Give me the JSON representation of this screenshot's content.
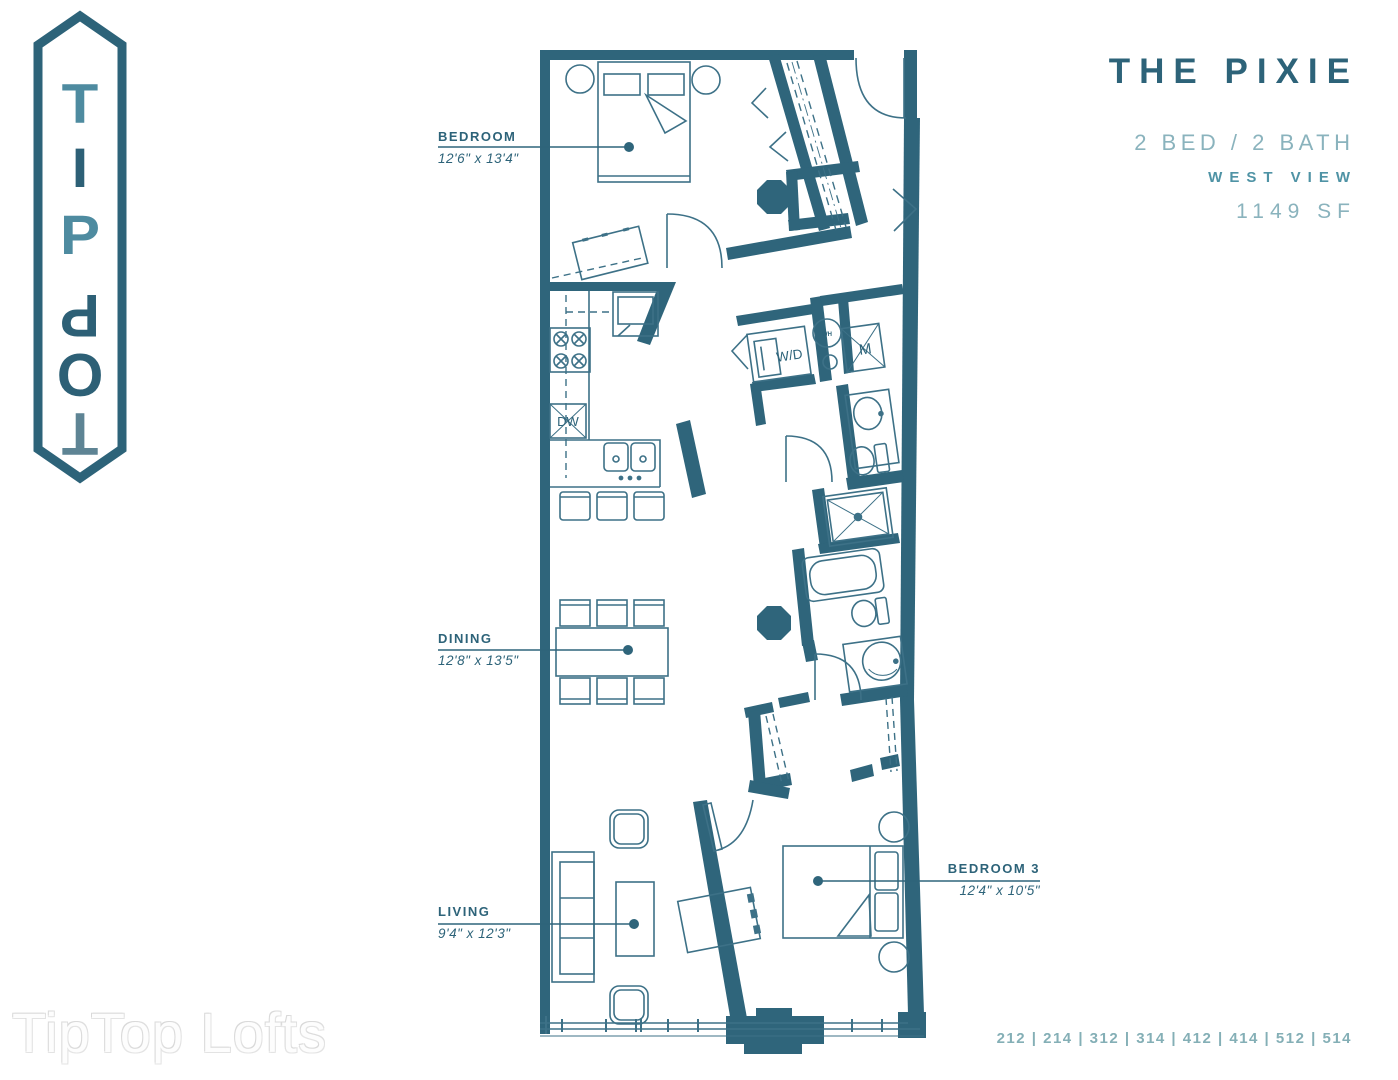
{
  "logo": {
    "brand": "TipTop",
    "letters": [
      "T",
      "I",
      "P",
      "P",
      "O",
      "T"
    ]
  },
  "title_block": {
    "name": "THE PIXIE",
    "beds_baths": "2 BED / 2 BATH",
    "view": "WEST VIEW",
    "area": "1149 SF"
  },
  "room_labels": [
    {
      "name": "BEDROOM",
      "dims": "12'6\" x 13'4\""
    },
    {
      "name": "DINING",
      "dims": "12'8\" x 13'5\""
    },
    {
      "name": "LIVING",
      "dims": "9'4\" x 12'3\""
    },
    {
      "name": "BEDROOM 3",
      "dims": "12'4\" x 10'5\""
    }
  ],
  "fixture_labels": {
    "washer_dryer": "W/D",
    "mechanical": "M",
    "water_heater": "WH",
    "dishwasher": "DW"
  },
  "units_list": "212 | 214 | 312 | 314 | 412 | 414 | 512 | 514",
  "watermark": "TipTop Lofts",
  "colors": {
    "wall_teal": "#2f657b",
    "dark_text": "#2d6379",
    "light_teal": "#8ab3bd",
    "view_teal": "#4f93a5",
    "units_teal": "#84afb6",
    "logo_light": "#4e8ba0",
    "logo_dark": "#2d6076",
    "logo_gray": "#5e8494"
  }
}
